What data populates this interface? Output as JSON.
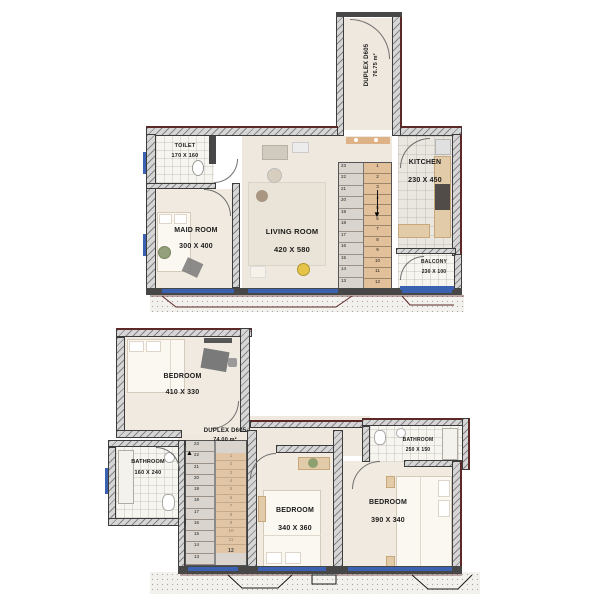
{
  "upper_plan": {
    "unit_label": "DUPLEX D605",
    "unit_area": "76.75 m²",
    "rooms": {
      "toilet": {
        "name": "TOILET",
        "dims": "170 X 160"
      },
      "maid_room": {
        "name": "MAID ROOM",
        "dims": "300 X 400"
      },
      "living_room": {
        "name": "LIVING ROOM",
        "dims": "420 X 580"
      },
      "kitchen": {
        "name": "KITCHEN",
        "dims": "230 X 450"
      },
      "balcony": {
        "name": "BALCONY",
        "dims": "230 X 100"
      }
    },
    "stairs": {
      "upper_flight_numbers": [
        "23",
        "22",
        "21",
        "20",
        "19",
        "18",
        "17",
        "16",
        "15",
        "14",
        "13"
      ],
      "lower_flight_numbers": [
        "1",
        "2",
        "3",
        "4",
        "5",
        "6",
        "7",
        "8",
        "9",
        "10",
        "11",
        "12"
      ],
      "direction_icon": "▼"
    }
  },
  "lower_plan": {
    "unit_label": "DUPLEX D605",
    "unit_area": "74.00 m²",
    "rooms": {
      "bedroom_top": {
        "name": "BEDROOM",
        "dims": "410 X 330"
      },
      "bathroom_left": {
        "name": "BATHROOM",
        "dims": "160 X 240"
      },
      "bedroom_middle": {
        "name": "BEDROOM",
        "dims": "340 X 360"
      },
      "bedroom_right": {
        "name": "BEDROOM",
        "dims": "390 X 340"
      },
      "bathroom_right": {
        "name": "BATHROOM",
        "dims": "250 X 150"
      }
    },
    "stairs": {
      "visible_flight_numbers": [
        "23",
        "22",
        "21",
        "20",
        "19",
        "18",
        "17",
        "16",
        "15",
        "14",
        "13"
      ],
      "under_flight_numbers": [
        "1",
        "2",
        "3",
        "4",
        "5",
        "6",
        "7",
        "8",
        "9",
        "10",
        "11"
      ],
      "landing_number": "12",
      "direction_icon": "▲"
    }
  },
  "colors": {
    "window_blue": "#3a62b0",
    "exterior_accent_maroon": "#5d2828",
    "wall_hatch_gray": "#d6d6d6",
    "wall_dark": "#474747",
    "floor_beige": "#f1eae0",
    "stair_wood": "#e2c09a"
  }
}
